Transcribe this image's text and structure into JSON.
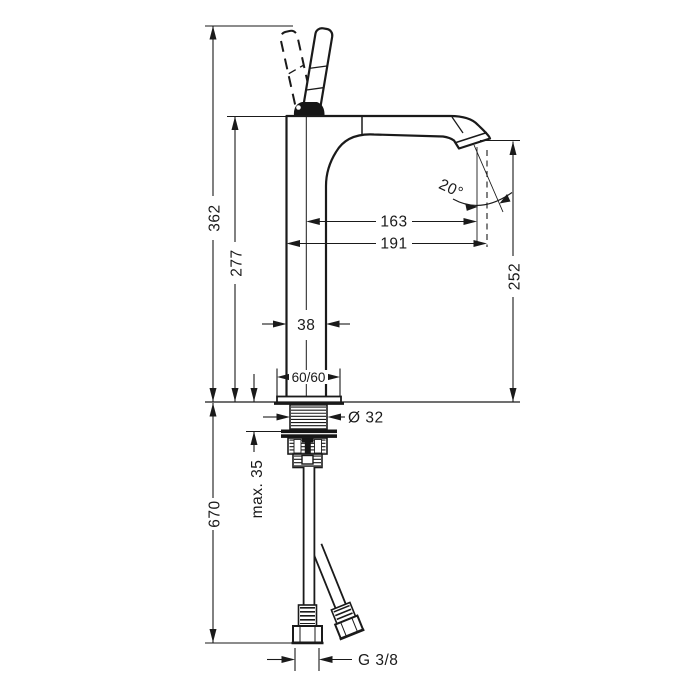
{
  "dimensions": {
    "height_total": "362",
    "height_to_spout_top": "277",
    "below_deck_height": "670",
    "outlet_height": "252",
    "spout_reach": "163",
    "overall_projection": "191",
    "body_width": "38",
    "base_plate": "60/60",
    "shank_diameter": "Ø 32",
    "max_mounting_thickness": "max. 35",
    "connection_thread": "G 3/8",
    "spout_angle": "20°"
  },
  "colors": {
    "line": "#1a1a1a",
    "background": "#ffffff",
    "solid_fill": "#161616"
  }
}
